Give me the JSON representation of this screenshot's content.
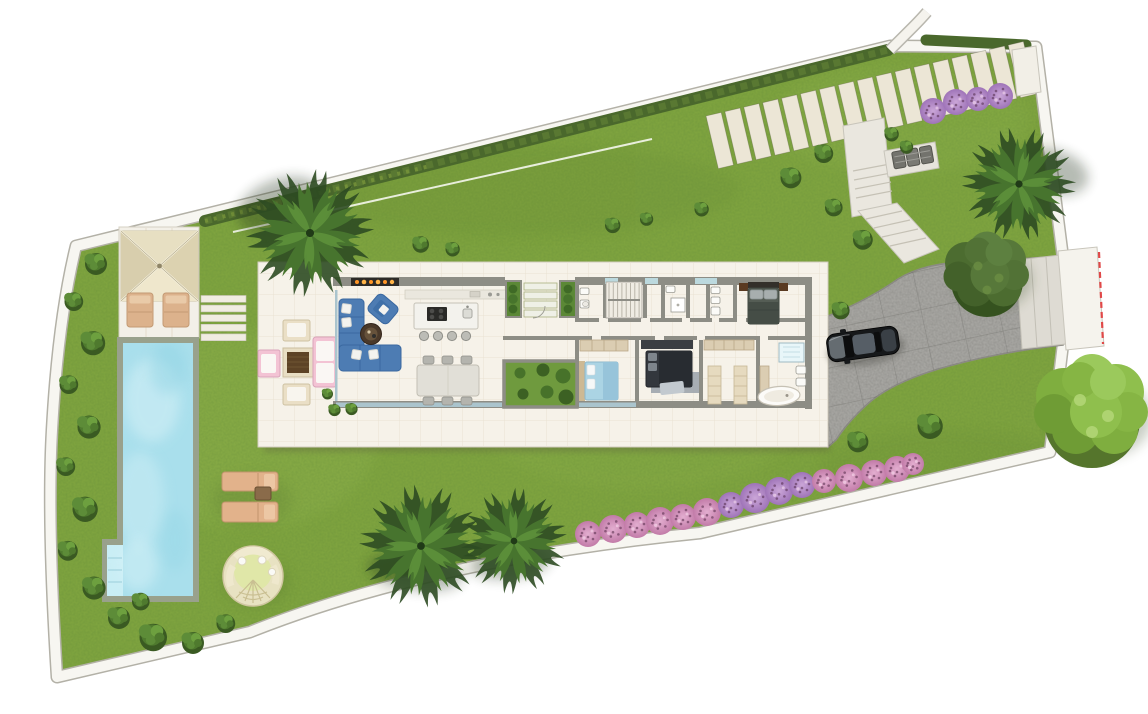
{
  "scene": "villa-site-plan-top-view",
  "palette": {
    "lawn": "#7ea33f",
    "lawnLight": "#95b654",
    "lawnDark": "#5d8030",
    "boundaryBand": "#f7f6f1",
    "boundaryLine": "#b3b1a7",
    "hedge": "#4a682c",
    "paver": "#ece6d6",
    "concretePath": "#eae7df",
    "driveway": "#a6a5a1",
    "drivewayEdge": "#8c8b85",
    "entrancePad": "#dedbd3",
    "gateWhite": "#f5f3ed",
    "gateDash": "#e04848",
    "platform": "#f6f2e9",
    "tileLine": "#e9e2d3",
    "wall": "#8d8d85",
    "glass": "#aac4cd",
    "poolCoping": "#99a18c",
    "poolWater": "#a9dfec",
    "poolSteps": "#c9eef5",
    "pergolaRoof": "#e9e1c6",
    "loungerTan": "#e2b28b",
    "daybed": "#e8e2c2",
    "daybedCenter": "#e0e7a8",
    "sofaBlue": "#4d7cb3",
    "bedBlue": "#abd4e4",
    "bedDark": "#33373d",
    "masterBed": "#555d55",
    "headboardWood": "#5a3a21",
    "woodDark": "#5d4326",
    "benchPink": "#f3c3d4",
    "wardrobe": "#dbcdb2",
    "fireplaceFlame": "#ff9526",
    "courtyardGrass": "#6f9a3e",
    "bushGreen": "#4f7a2e",
    "pinkBush": "#d193bd",
    "violetBush": "#b48ac2",
    "carBody": "#16181a",
    "carRoof": "#565e66",
    "carHood": "#6e757b"
  },
  "inventory": {
    "paver_walkway_slabs": 17,
    "pink_bushes_bottom_row": 15,
    "pink_bushes_top_row": 4,
    "palm_trees": 4,
    "round_trees": 2,
    "pergola_loungers": 2,
    "pool_sun_loungers": 2,
    "dining_chairs": 6,
    "bar_stools": 4,
    "terrace_chairs": 3,
    "bedrooms": 3,
    "bathrooms": 3,
    "equipment_units": 3,
    "stepping_treads": 5
  },
  "plan": {
    "pavers": {
      "count": 17,
      "ox": 706,
      "oy": 116,
      "angle": -13.2,
      "step": 19.4,
      "w": 15.6,
      "h": 54
    },
    "treads": {
      "count": 5,
      "x": 201,
      "y": 295.5,
      "step": 9.6,
      "w": 45,
      "h": 6.8
    },
    "pink_bottom": [
      [
        588,
        534,
        13
      ],
      [
        613,
        529,
        14
      ],
      [
        637,
        525,
        13
      ],
      [
        660,
        521,
        14
      ],
      [
        683,
        517,
        13
      ],
      [
        707,
        512,
        14
      ],
      [
        731,
        505,
        13
      ],
      [
        755,
        498,
        15
      ],
      [
        779,
        491,
        14
      ],
      [
        802,
        485,
        13
      ],
      [
        824,
        481,
        12
      ],
      [
        849,
        478,
        14
      ],
      [
        874,
        473,
        13
      ],
      [
        897,
        469,
        13
      ],
      [
        913,
        464,
        11
      ]
    ],
    "pink_bottom_violet": [
      6,
      7,
      8,
      9
    ],
    "pink_top": [
      [
        933,
        111,
        13
      ],
      [
        956,
        102,
        13
      ],
      [
        978,
        99,
        12
      ],
      [
        1000,
        96,
        13
      ]
    ],
    "green_bushes": [
      [
        95,
        262,
        1.0
      ],
      [
        73,
        300,
        0.85
      ],
      [
        92,
        341,
        1.1
      ],
      [
        68,
        383,
        0.85
      ],
      [
        88,
        425,
        1.05
      ],
      [
        65,
        465,
        0.85
      ],
      [
        84,
        507,
        1.15
      ],
      [
        67,
        549,
        0.9
      ],
      [
        93,
        586,
        1.05
      ],
      [
        118,
        616,
        1.0
      ],
      [
        152,
        635,
        1.25
      ],
      [
        192,
        641,
        1.0
      ],
      [
        225,
        622,
        0.85
      ],
      [
        140,
        600,
        0.8
      ],
      [
        420,
        243,
        0.75
      ],
      [
        452,
        248,
        0.65
      ],
      [
        612,
        224,
        0.7
      ],
      [
        646,
        218,
        0.6
      ],
      [
        701,
        208,
        0.65
      ],
      [
        790,
        176,
        0.95
      ],
      [
        823,
        152,
        0.85
      ],
      [
        833,
        206,
        0.8
      ],
      [
        862,
        238,
        0.9
      ],
      [
        891,
        133,
        0.65
      ],
      [
        906,
        146,
        0.6
      ],
      [
        840,
        309,
        0.8
      ],
      [
        857,
        440,
        0.95
      ],
      [
        929,
        424,
        1.15
      ],
      [
        327,
        393,
        0.5
      ],
      [
        334,
        409,
        0.55
      ],
      [
        351,
        408,
        0.55
      ]
    ],
    "palms": [
      [
        310,
        233,
        1.35,
        10
      ],
      [
        1019,
        184,
        1.2,
        -15
      ],
      [
        421,
        546,
        1.3,
        25
      ],
      [
        514,
        541,
        1.12,
        -30
      ]
    ],
    "palm_shadows": [
      [
        280,
        205,
        44,
        26,
        -20
      ],
      [
        1053,
        172,
        36,
        22,
        15
      ],
      [
        415,
        572,
        48,
        18,
        8
      ],
      [
        510,
        563,
        40,
        16,
        -6
      ]
    ],
    "trees": [
      [
        987,
        272,
        1.5,
        "olive"
      ],
      [
        1092,
        408,
        2.0,
        "light"
      ]
    ],
    "courtyard_bushes": [
      [
        520,
        373
      ],
      [
        543,
        370
      ],
      [
        563,
        376
      ],
      [
        523,
        394
      ],
      [
        547,
        392
      ],
      [
        566,
        397
      ]
    ],
    "stools_x": [
      424,
      438,
      452,
      466
    ],
    "chairs_x": [
      423,
      442,
      461
    ]
  }
}
